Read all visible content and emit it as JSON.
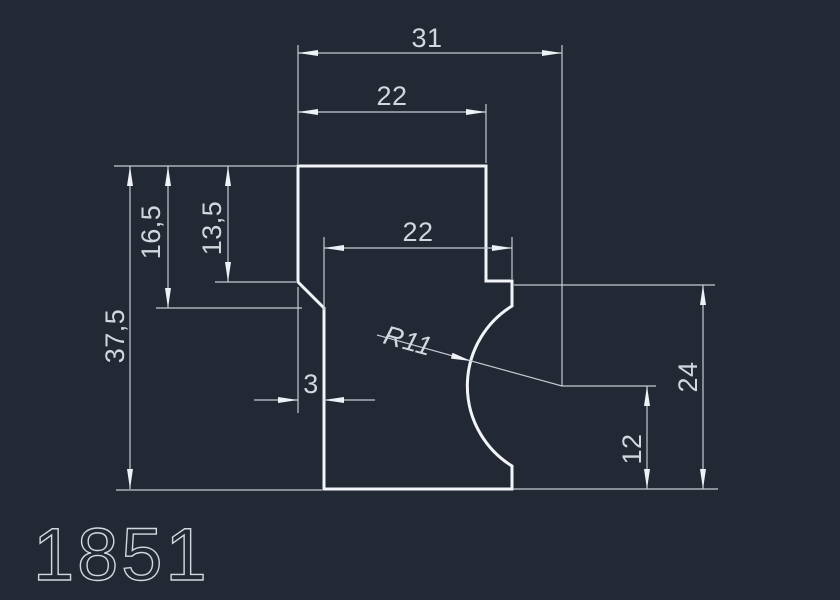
{
  "title": {
    "part_number": "1851"
  },
  "colors": {
    "background": "#232934",
    "outline": "#f2f4f7",
    "dim_line": "#c3cad3",
    "arrow": "#eef1f5",
    "label": "#d2d7de"
  },
  "dimensions": {
    "overall_width": "31",
    "top_width": "22",
    "body_width": "22",
    "overall_height": "37,5",
    "left_lower_depth": "16,5",
    "left_upper_depth": "13,5",
    "chamfer_width": "3",
    "arc_radius": "R11",
    "arc_center_height": "12",
    "right_height": "24"
  }
}
